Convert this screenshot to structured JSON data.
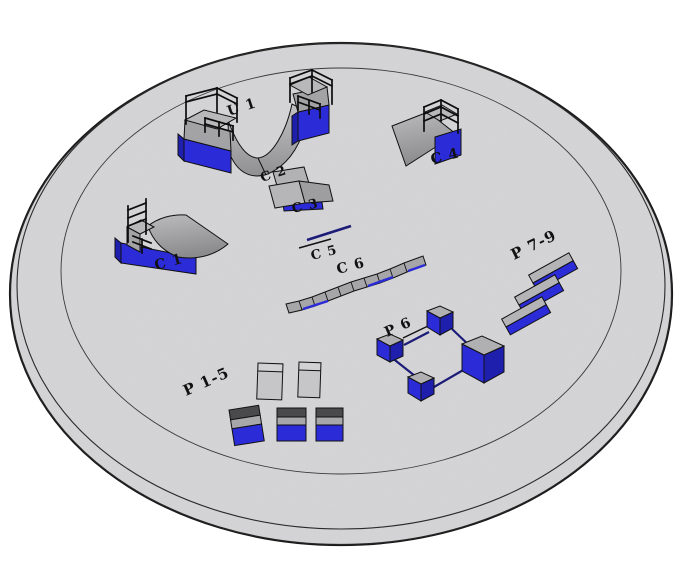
{
  "scene": {
    "title": "Circular skatepark obstacle layout (3D view)",
    "floor": {
      "shape": "disc",
      "rings": 3,
      "fill": "#d5d5d7",
      "outline": "#1a1a1a"
    },
    "labels": {
      "u1": "U 1",
      "c1": "C 1",
      "c2": "C 2",
      "c3": "C 3",
      "c4": "C 4",
      "c5": "C 5",
      "c6": "C 6",
      "p15": "P 1-5",
      "p6": "P 6",
      "p79": "P 7-9"
    },
    "obstacles": [
      {
        "id": "U 1",
        "type": "halfpipe-with-railed-decks"
      },
      {
        "id": "C 1",
        "type": "quarterpipe-railed"
      },
      {
        "id": "C 2",
        "type": "kicker-ramp"
      },
      {
        "id": "C 3",
        "type": "kicker-ramp"
      },
      {
        "id": "C 4",
        "type": "quarterpipe-railed"
      },
      {
        "id": "C 5",
        "type": "flat-rail"
      },
      {
        "id": "C 6",
        "type": "long-segmented-ledge"
      },
      {
        "id": "P 1-5",
        "type": "boxes-and-pads"
      },
      {
        "id": "P 6",
        "type": "cubes-linked-by-rails"
      },
      {
        "id": "P 7-9",
        "type": "three-parallel-ledges"
      }
    ],
    "colors": {
      "floor_grey": "#d5d5d7",
      "obstacle_grey": "#a9a9ab",
      "deck_grey": "#b8b8ba",
      "pad_grey": "#c6c6c8",
      "dark_band": "#4a4a4c",
      "blue": "#2b2bd8",
      "blue_dark": "#1f1fae",
      "rail_navy": "#1b1b78",
      "outline_black": "#111111"
    }
  }
}
